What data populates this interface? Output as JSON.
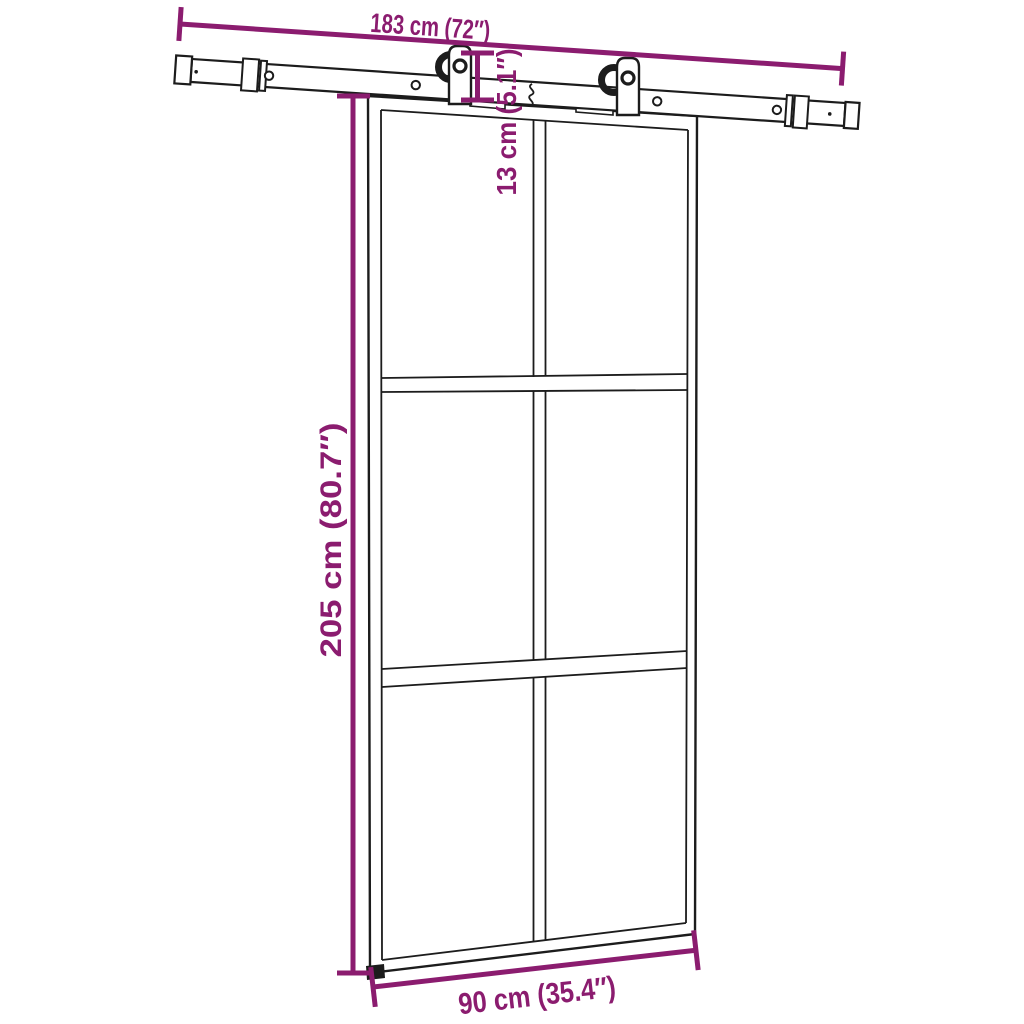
{
  "colors": {
    "background": "#ffffff",
    "line_art": "#1c1c1c",
    "dimension": "#8b1c6f"
  },
  "diagram": {
    "kind": "product-dimension-line-drawing",
    "product_parts": [
      "sliding-rail-with-end-stops",
      "roller-hanger-left",
      "roller-hanger-right",
      "glass-sliding-door-six-panes",
      "floor-guide"
    ]
  },
  "dimensions": {
    "rail_width": {
      "label": "183 cm (72″)"
    },
    "hanger_drop": {
      "label": "13 cm (5.1″)"
    },
    "door_height": {
      "label": "205 cm (80.7″)"
    },
    "door_width": {
      "label": "90 cm (35.4″)"
    }
  }
}
